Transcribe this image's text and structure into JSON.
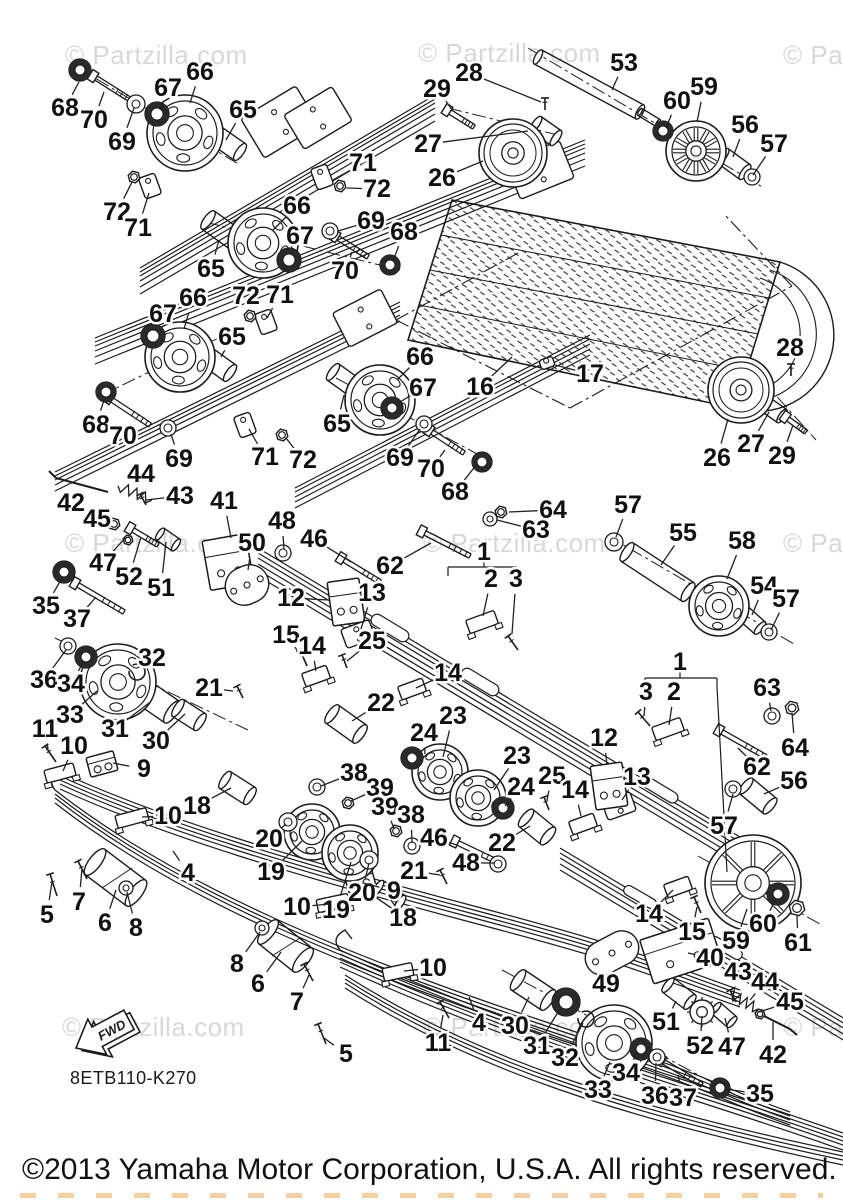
{
  "page": {
    "diagram_code": "8ETB110-K270",
    "fwd_label": "FWD",
    "copyright": "©2013 Yamaha Motor Corporation, U.S.A. All rights reserved."
  },
  "watermark": {
    "full_text": "© Partzilla.com",
    "color": "#d8d8d8",
    "positions": [
      {
        "x": 65,
        "y": 40
      },
      {
        "x": 418,
        "y": 38
      },
      {
        "x": 783,
        "y": 40
      },
      {
        "x": 65,
        "y": 528
      },
      {
        "x": 423,
        "y": 528
      },
      {
        "x": 783,
        "y": 528
      },
      {
        "x": 62,
        "y": 1012
      },
      {
        "x": 423,
        "y": 1012
      },
      {
        "x": 783,
        "y": 1012
      }
    ]
  },
  "colors": {
    "line": "#1c1c1c",
    "background": "#ffffff",
    "label": "#111111",
    "watermark": "#d8d8d8",
    "artifact": "#e8a04a"
  },
  "callouts": [
    [
      "66",
      200,
      72,
      190,
      103
    ],
    [
      "67",
      168,
      88,
      160,
      110
    ],
    [
      "68",
      65,
      108,
      79,
      82
    ],
    [
      "70",
      94,
      120,
      104,
      92
    ],
    [
      "69",
      122,
      142,
      134,
      108
    ],
    [
      "65",
      243,
      110,
      226,
      140
    ],
    [
      "72",
      117,
      212,
      132,
      182
    ],
    [
      "71",
      138,
      228,
      149,
      193
    ],
    [
      "29",
      437,
      89,
      453,
      111
    ],
    [
      "28",
      469,
      73,
      541,
      102
    ],
    [
      "27",
      428,
      144,
      528,
      131
    ],
    [
      "26",
      442,
      178,
      483,
      161
    ],
    [
      "53",
      624,
      63,
      612,
      90
    ],
    [
      "59",
      704,
      87,
      697,
      122
    ],
    [
      "60",
      677,
      101,
      666,
      128
    ],
    [
      "56",
      745,
      125,
      733,
      157
    ],
    [
      "57",
      774,
      144,
      753,
      175
    ],
    [
      "71",
      363,
      163,
      333,
      180
    ],
    [
      "72",
      377,
      189,
      347,
      188
    ],
    [
      "66",
      297,
      206,
      273,
      230
    ],
    [
      "67",
      300,
      236,
      291,
      255
    ],
    [
      "69",
      371,
      221,
      338,
      231
    ],
    [
      "68",
      404,
      232,
      393,
      261
    ],
    [
      "70",
      345,
      271,
      352,
      252
    ],
    [
      "65",
      211,
      269,
      219,
      240
    ],
    [
      "66",
      193,
      298,
      184,
      329
    ],
    [
      "67",
      163,
      314,
      156,
      332
    ],
    [
      "72",
      246,
      296,
      251,
      313
    ],
    [
      "71",
      280,
      295,
      267,
      318
    ],
    [
      "65",
      232,
      337,
      221,
      357
    ],
    [
      "68",
      96,
      425,
      105,
      397
    ],
    [
      "70",
      123,
      436,
      132,
      420
    ],
    [
      "69",
      179,
      459,
      171,
      434
    ],
    [
      "71",
      265,
      457,
      249,
      429
    ],
    [
      "72",
      303,
      460,
      286,
      438
    ],
    [
      "66",
      420,
      357,
      397,
      380
    ],
    [
      "67",
      423,
      388,
      395,
      405
    ],
    [
      "65",
      337,
      424,
      344,
      395
    ],
    [
      "69",
      400,
      458,
      420,
      429
    ],
    [
      "70",
      431,
      469,
      445,
      450
    ],
    [
      "68",
      455,
      492,
      477,
      464
    ],
    [
      "16",
      480,
      387,
      512,
      357
    ],
    [
      "17",
      590,
      374,
      555,
      365
    ],
    [
      "28",
      790,
      348,
      791,
      366
    ],
    [
      "27",
      751,
      444,
      769,
      412
    ],
    [
      "26",
      717,
      458,
      728,
      419
    ],
    [
      "29",
      782,
      456,
      793,
      425
    ],
    [
      "57",
      628,
      505,
      616,
      537
    ],
    [
      "55",
      683,
      533,
      661,
      565
    ],
    [
      "58",
      742,
      541,
      727,
      579
    ],
    [
      "54",
      764,
      586,
      752,
      615
    ],
    [
      "57",
      786,
      599,
      771,
      630
    ],
    [
      "62",
      390,
      566,
      431,
      543
    ],
    [
      "63",
      536,
      530,
      497,
      520
    ],
    [
      "64",
      553,
      510,
      509,
      512
    ],
    [
      "1",
      484,
      552
    ],
    [
      "2",
      491,
      579,
      483,
      616
    ],
    [
      "3",
      516,
      579,
      512,
      634
    ],
    [
      "48",
      282,
      521,
      284,
      549
    ],
    [
      "46",
      314,
      539,
      351,
      562
    ],
    [
      "12",
      291,
      598,
      329,
      600
    ],
    [
      "13",
      372,
      593,
      361,
      629
    ],
    [
      "25",
      372,
      641,
      347,
      661
    ],
    [
      "15",
      286,
      635,
      300,
      654
    ],
    [
      "14",
      312,
      646,
      316,
      671
    ],
    [
      "14",
      448,
      673,
      416,
      688
    ],
    [
      "41",
      224,
      501,
      231,
      538
    ],
    [
      "42",
      71,
      503,
      79,
      485
    ],
    [
      "44",
      141,
      474,
      133,
      488
    ],
    [
      "43",
      180,
      496,
      146,
      500
    ],
    [
      "45",
      97,
      519,
      112,
      521
    ],
    [
      "47",
      103,
      563,
      125,
      538
    ],
    [
      "52",
      129,
      577,
      141,
      537
    ],
    [
      "51",
      161,
      588,
      166,
      542
    ],
    [
      "50",
      252,
      543,
      248,
      570
    ],
    [
      "35",
      46,
      606,
      62,
      578
    ],
    [
      "37",
      77,
      619,
      96,
      597
    ],
    [
      "36",
      44,
      680,
      66,
      650
    ],
    [
      "34",
      71,
      684,
      84,
      661
    ],
    [
      "33",
      70,
      715,
      97,
      691
    ],
    [
      "32",
      152,
      658,
      139,
      669
    ],
    [
      "21",
      209,
      688,
      233,
      691
    ],
    [
      "30",
      156,
      741,
      185,
      714
    ],
    [
      "31",
      115,
      729,
      149,
      703
    ],
    [
      "11",
      45,
      729,
      48,
      749
    ],
    [
      "10",
      74,
      746,
      63,
      771
    ],
    [
      "9",
      144,
      769,
      113,
      763
    ],
    [
      "18",
      197,
      806,
      231,
      788
    ],
    [
      "10",
      168,
      816,
      142,
      817
    ],
    [
      "4",
      188,
      873,
      173,
      851
    ],
    [
      "20",
      269,
      839,
      286,
      824
    ],
    [
      "19",
      271,
      872,
      302,
      841
    ],
    [
      "5",
      47,
      915,
      52,
      882
    ],
    [
      "7",
      79,
      902,
      82,
      868
    ],
    [
      "6",
      105,
      923,
      116,
      890
    ],
    [
      "8",
      136,
      928,
      127,
      892
    ],
    [
      "22",
      381,
      703,
      352,
      721
    ],
    [
      "23",
      453,
      716,
      443,
      757
    ],
    [
      "24",
      424,
      733,
      425,
      754
    ],
    [
      "38",
      354,
      773,
      321,
      786
    ],
    [
      "39",
      380,
      788,
      351,
      801
    ],
    [
      "39",
      385,
      807,
      394,
      828
    ],
    [
      "38",
      411,
      815,
      412,
      843
    ],
    [
      "23",
      517,
      756,
      494,
      790
    ],
    [
      "24",
      521,
      787,
      505,
      806
    ],
    [
      "25",
      552,
      776,
      547,
      800
    ],
    [
      "46",
      434,
      838,
      457,
      845
    ],
    [
      "48",
      466,
      863,
      495,
      863
    ],
    [
      "22",
      502,
      843,
      530,
      826
    ],
    [
      "21",
      414,
      871,
      440,
      875
    ],
    [
      "20",
      362,
      893,
      369,
      863
    ],
    [
      "19",
      336,
      910,
      351,
      862
    ],
    [
      "9",
      394,
      891,
      363,
      883
    ],
    [
      "10",
      297,
      907,
      330,
      904
    ],
    [
      "18",
      403,
      918,
      391,
      900
    ],
    [
      "10",
      433,
      968,
      404,
      971
    ],
    [
      "11",
      438,
      1043,
      443,
      1015
    ],
    [
      "4",
      479,
      1023,
      469,
      997
    ],
    [
      "7",
      297,
      1002,
      309,
      975
    ],
    [
      "5",
      346,
      1054,
      324,
      1038
    ],
    [
      "6",
      258,
      984,
      281,
      952
    ],
    [
      "8",
      237,
      964,
      260,
      932
    ],
    [
      "30",
      515,
      1026,
      529,
      997
    ],
    [
      "31",
      537,
      1046,
      560,
      1009
    ],
    [
      "32",
      565,
      1058,
      583,
      1023
    ],
    [
      "33",
      598,
      1090,
      610,
      1062
    ],
    [
      "34",
      626,
      1073,
      638,
      1052
    ],
    [
      "36",
      655,
      1096,
      656,
      1063
    ],
    [
      "37",
      683,
      1098,
      678,
      1075
    ],
    [
      "35",
      760,
      1094,
      725,
      1089
    ],
    [
      "49",
      606,
      984,
      611,
      966
    ],
    [
      "40",
      710,
      958,
      688,
      953
    ],
    [
      "43",
      738,
      972,
      733,
      996
    ],
    [
      "44",
      765,
      982,
      750,
      1000
    ],
    [
      "45",
      790,
      1002,
      759,
      1012
    ],
    [
      "51",
      666,
      1022,
      676,
      1001
    ],
    [
      "52",
      700,
      1046,
      702,
      1016
    ],
    [
      "47",
      732,
      1047,
      725,
      1018
    ],
    [
      "42",
      773,
      1055,
      773,
      1022
    ],
    [
      "14",
      649,
      914,
      673,
      890
    ],
    [
      "15",
      692,
      932,
      697,
      907
    ],
    [
      "59",
      736,
      941,
      747,
      909
    ],
    [
      "60",
      763,
      924,
      776,
      899
    ],
    [
      "61",
      798,
      943,
      797,
      916
    ],
    [
      "62",
      757,
      767,
      738,
      748
    ],
    [
      "63",
      767,
      688,
      771,
      711
    ],
    [
      "64",
      795,
      748,
      792,
      713
    ],
    [
      "56",
      794,
      781,
      764,
      794
    ],
    [
      "57",
      724,
      826,
      733,
      794
    ],
    [
      "12",
      604,
      738,
      607,
      765
    ],
    [
      "13",
      637,
      777,
      622,
      800
    ],
    [
      "14",
      575,
      790,
      581,
      816
    ],
    [
      "1",
      680,
      662
    ],
    [
      "2",
      674,
      692,
      669,
      725
    ],
    [
      "3",
      646,
      692,
      644,
      716
    ]
  ]
}
